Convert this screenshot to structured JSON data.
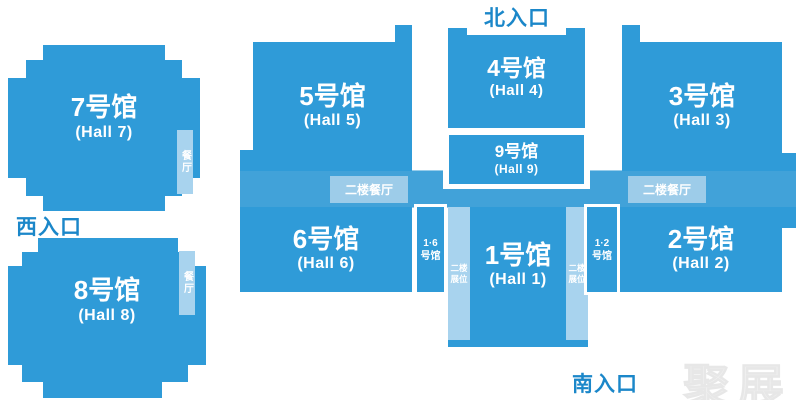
{
  "map_title": "exhibition-center-floor-plan",
  "colors": {
    "hall_blue": "#2f9bd8",
    "corridor_blue": "#41a2d9",
    "light_strip_blue": "#a8d3ee",
    "light_box_blue": "#9dcce9",
    "entrance_text_blue": "#1b87c9",
    "watermark_gray": "#f0f0f0",
    "hall_text": "#ffffff"
  },
  "entrances": {
    "north": "北入口",
    "west": "西入口",
    "south": "南入口"
  },
  "halls": {
    "h1": {
      "name": "1号馆",
      "en": "(Hall 1)"
    },
    "h2": {
      "name": "2号馆",
      "en": "(Hall 2)"
    },
    "h3": {
      "name": "3号馆",
      "en": "(Hall 3)"
    },
    "h4": {
      "name": "4号馆",
      "en": "(Hall 4)"
    },
    "h5": {
      "name": "5号馆",
      "en": "(Hall 5)"
    },
    "h6": {
      "name": "6号馆",
      "en": "(Hall 6)"
    },
    "h7": {
      "name": "7号馆",
      "en": "(Hall 7)"
    },
    "h8": {
      "name": "8号馆",
      "en": "(Hall 8)"
    },
    "h9": {
      "name": "9号馆",
      "en": "(Hall 9)"
    }
  },
  "labels": {
    "second_floor_restaurant": "二楼餐厅",
    "restaurant": "餐厅",
    "second_floor_booths": {
      "line1": "二楼",
      "line2": "展位"
    },
    "connector_16": {
      "line1": "1·6",
      "line2": "号馆"
    },
    "connector_12": {
      "line1": "1·2",
      "line2": "号馆"
    }
  },
  "watermark": "聚展"
}
